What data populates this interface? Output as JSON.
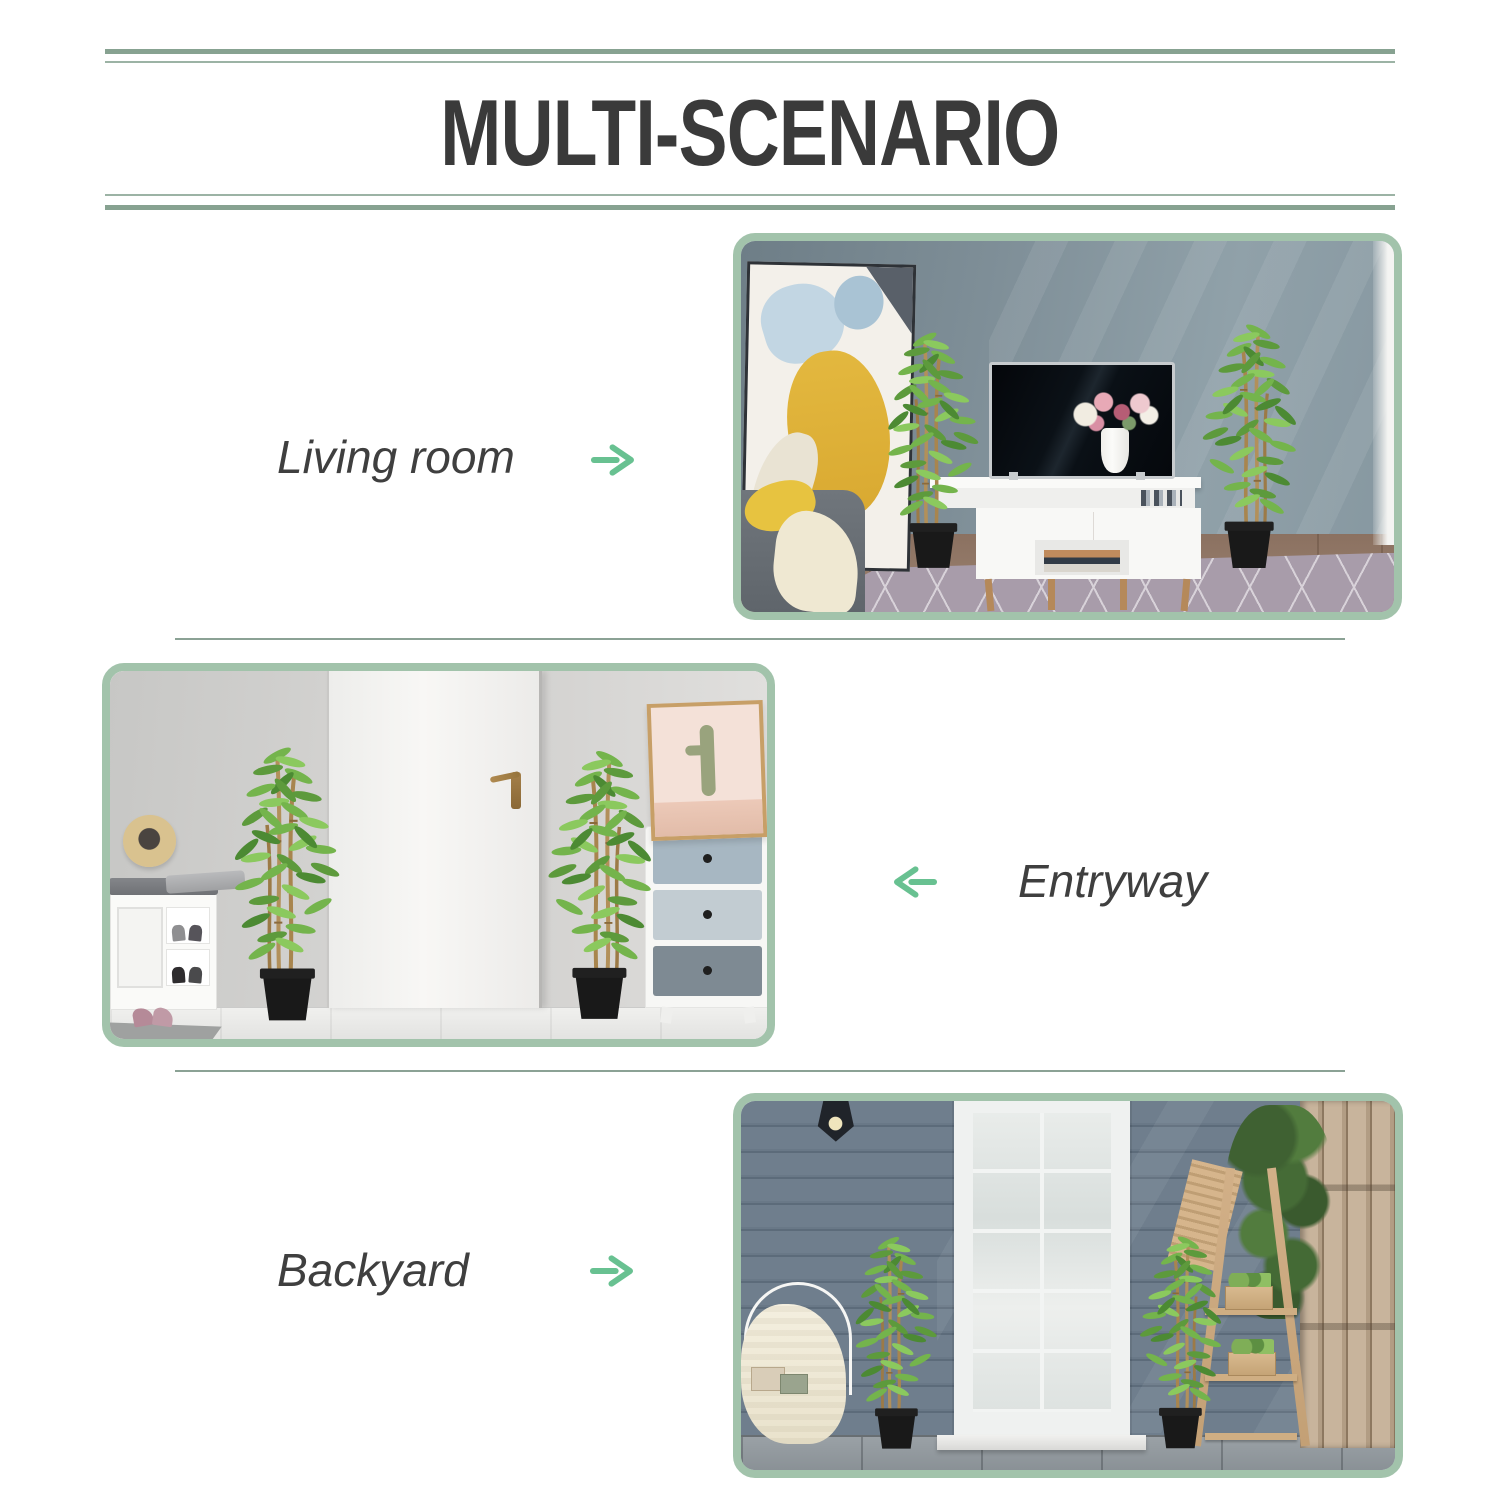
{
  "page": {
    "title": "MULTI-SCENARIO"
  },
  "sections": [
    {
      "id": "living-room",
      "label": "Living room",
      "arrow_direction": "right",
      "arrow_glyph": "→",
      "photo_description": "Two artificial bamboo plants in black pots flanking a white TV stand in a living room with abstract wall art, gray sofa and patterned rug"
    },
    {
      "id": "entryway",
      "label": "Entryway",
      "arrow_direction": "left",
      "arrow_glyph": "←",
      "photo_description": "Two artificial bamboo plants in black pots on either side of a white front door in an entryway with shoe bench, straw hat, cactus print and drawer chest"
    },
    {
      "id": "backyard",
      "label": "Backyard",
      "arrow_direction": "right",
      "arrow_glyph": "→",
      "photo_description": "Two artificial bamboo plants in black pots flanking a white patio door against blue siding with a wooden ladder plant stand and fence"
    }
  ],
  "colors": {
    "line_green_dark": "#87a291",
    "line_green_light": "#9cb3a5",
    "photo_border_green": "#a2c3ab",
    "arrow_green": "#68c191",
    "title_text": "#3a3a3a",
    "label_text": "#3f3f3f",
    "background": "#ffffff"
  }
}
